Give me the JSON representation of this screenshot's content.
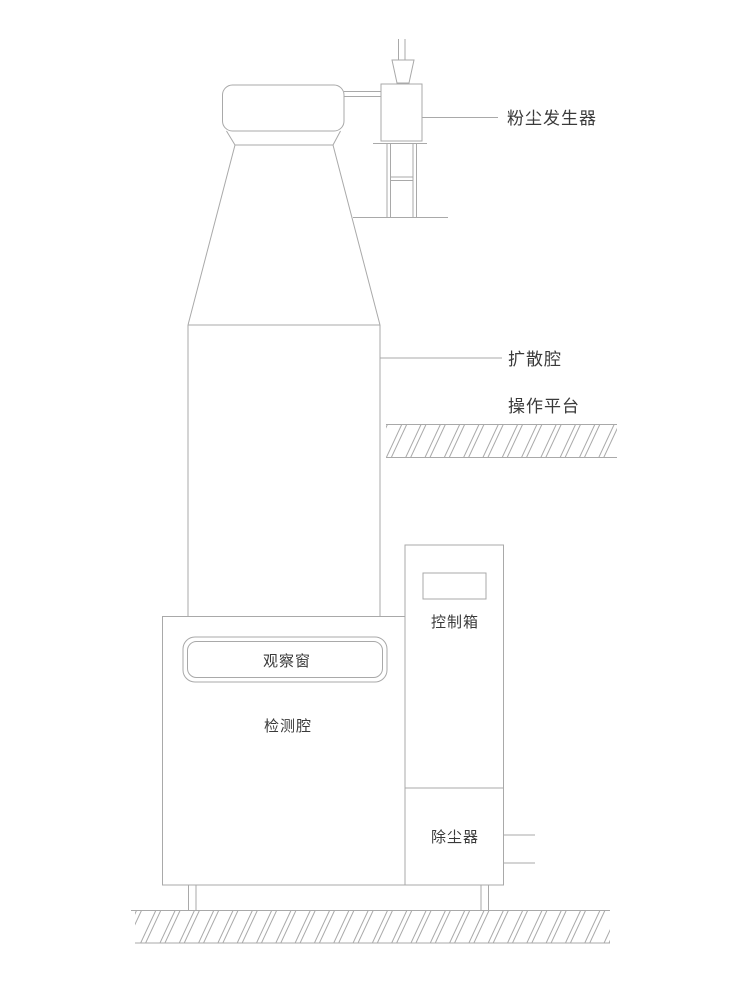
{
  "diagram": {
    "labels": {
      "dust_generator": "粉尘发生器",
      "diffusion_chamber": "扩散腔",
      "operating_platform": "操作平台",
      "control_box": "控制箱",
      "observation_window": "观察窗",
      "detection_chamber": "检测腔",
      "dust_remover": "除尘器"
    },
    "colors": {
      "line": "#a9a9a9",
      "text": "#3a3a3a",
      "background": "#ffffff"
    }
  }
}
